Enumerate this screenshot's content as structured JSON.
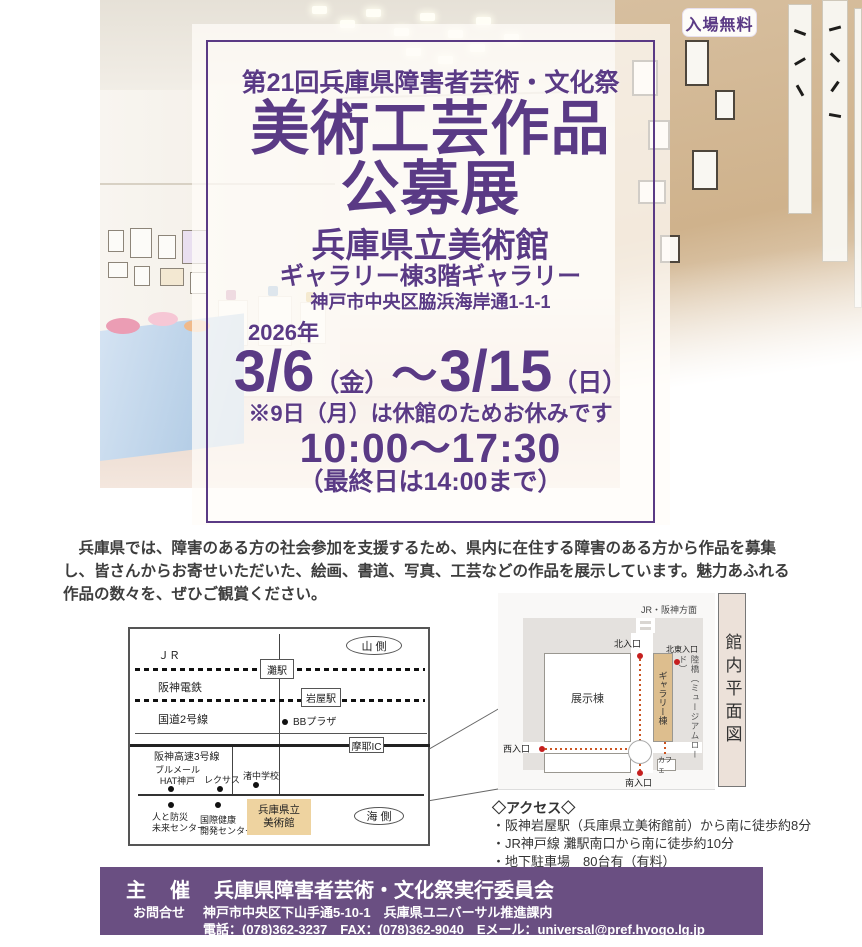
{
  "colors": {
    "accent_purple": "#5a3a85",
    "footer_purple": "#6a4f82",
    "route_red": "#c51f1f",
    "museum_tan": "#eed3a0",
    "gallery_tan": "#ddbe8e"
  },
  "badge": {
    "label": "入場無料"
  },
  "hero": {
    "festival_title": "第21回兵庫県障害者芸術・文化祭",
    "main_title_line1": "美術工芸作品",
    "main_title_line2": "公募展",
    "venue_name": "兵庫県立美術館",
    "venue_detail": "ギャラリー棟3階ギャラリー",
    "venue_address": "神戸市中央区脇浜海岸通1-1-1",
    "year": "2026年",
    "date_start": "3/6",
    "date_start_day": "（金）",
    "date_tilde": "～",
    "date_end": "3/15",
    "date_end_day": "（日）",
    "closed_note": "※9日（月）は休館のためお休みです",
    "hours": "10:00～17:30",
    "hours_note": "（最終日は14:00まで）"
  },
  "intro": {
    "text": "兵庫県では、障害のある方の社会参加を支援するため、県内に在住する障害のある方から作品を募集し、皆さんからお寄せいただいた、絵画、書道、写真、工芸などの作品を展示しています。魅力あふれる作品の数々を、ぜひご観賞ください。"
  },
  "area_map": {
    "mountain_side": "山 側",
    "sea_side": "海 側",
    "jr_label": "ＪＲ",
    "nada_station": "灘駅",
    "hanshin_label": "阪神電鉄",
    "iwaya_station": "岩屋駅",
    "route2_label": "国道2号線",
    "bb_plaza": "BBプラザ",
    "maya_ic": "摩耶IC",
    "hanshin_exp": "阪神高速3号線",
    "brumaire": "ブルメール\nHAT神戸",
    "lexus": "レクサス",
    "nagisa_school": "渚中学校",
    "disaster_center": "人と防災\n未来センター",
    "health_center": "国際健康\n開発センター",
    "museum_label": "兵庫県立\n美術館"
  },
  "floor_map": {
    "direction_label": "JR・阪神方面",
    "north_entrance": "北入口",
    "northeast_entrance": "北東入口",
    "exhibition_bldg": "展示棟",
    "gallery_bldg": "ギャラリー棟",
    "bridge_label": "陸橋（ミュージアムロード）",
    "west_entrance": "西入口",
    "south_entrance": "南入口",
    "cafe": "カフェ",
    "plan_title": "館内平面図"
  },
  "access": {
    "title": "◇アクセス◇",
    "items": [
      "・阪神岩屋駅（兵庫県立美術館前）から南に徒歩約8分",
      "・JR神戸線 灘駅南口から南に徒歩約10分",
      "・地下駐車場　80台有（有料）"
    ]
  },
  "footer": {
    "organizer_label": "主　催",
    "organizer": "兵庫県障害者芸術・文化祭実行委員会",
    "contact_label": "お問合せ",
    "contact_address": "神戸市中央区下山手通5-10-1　兵庫県ユニバーサル推進課内",
    "contact_tel": "電話：(078)362-3237　FAX：(078)362-9040　Eメール：universal@pref.hyogo.lg.jp"
  }
}
